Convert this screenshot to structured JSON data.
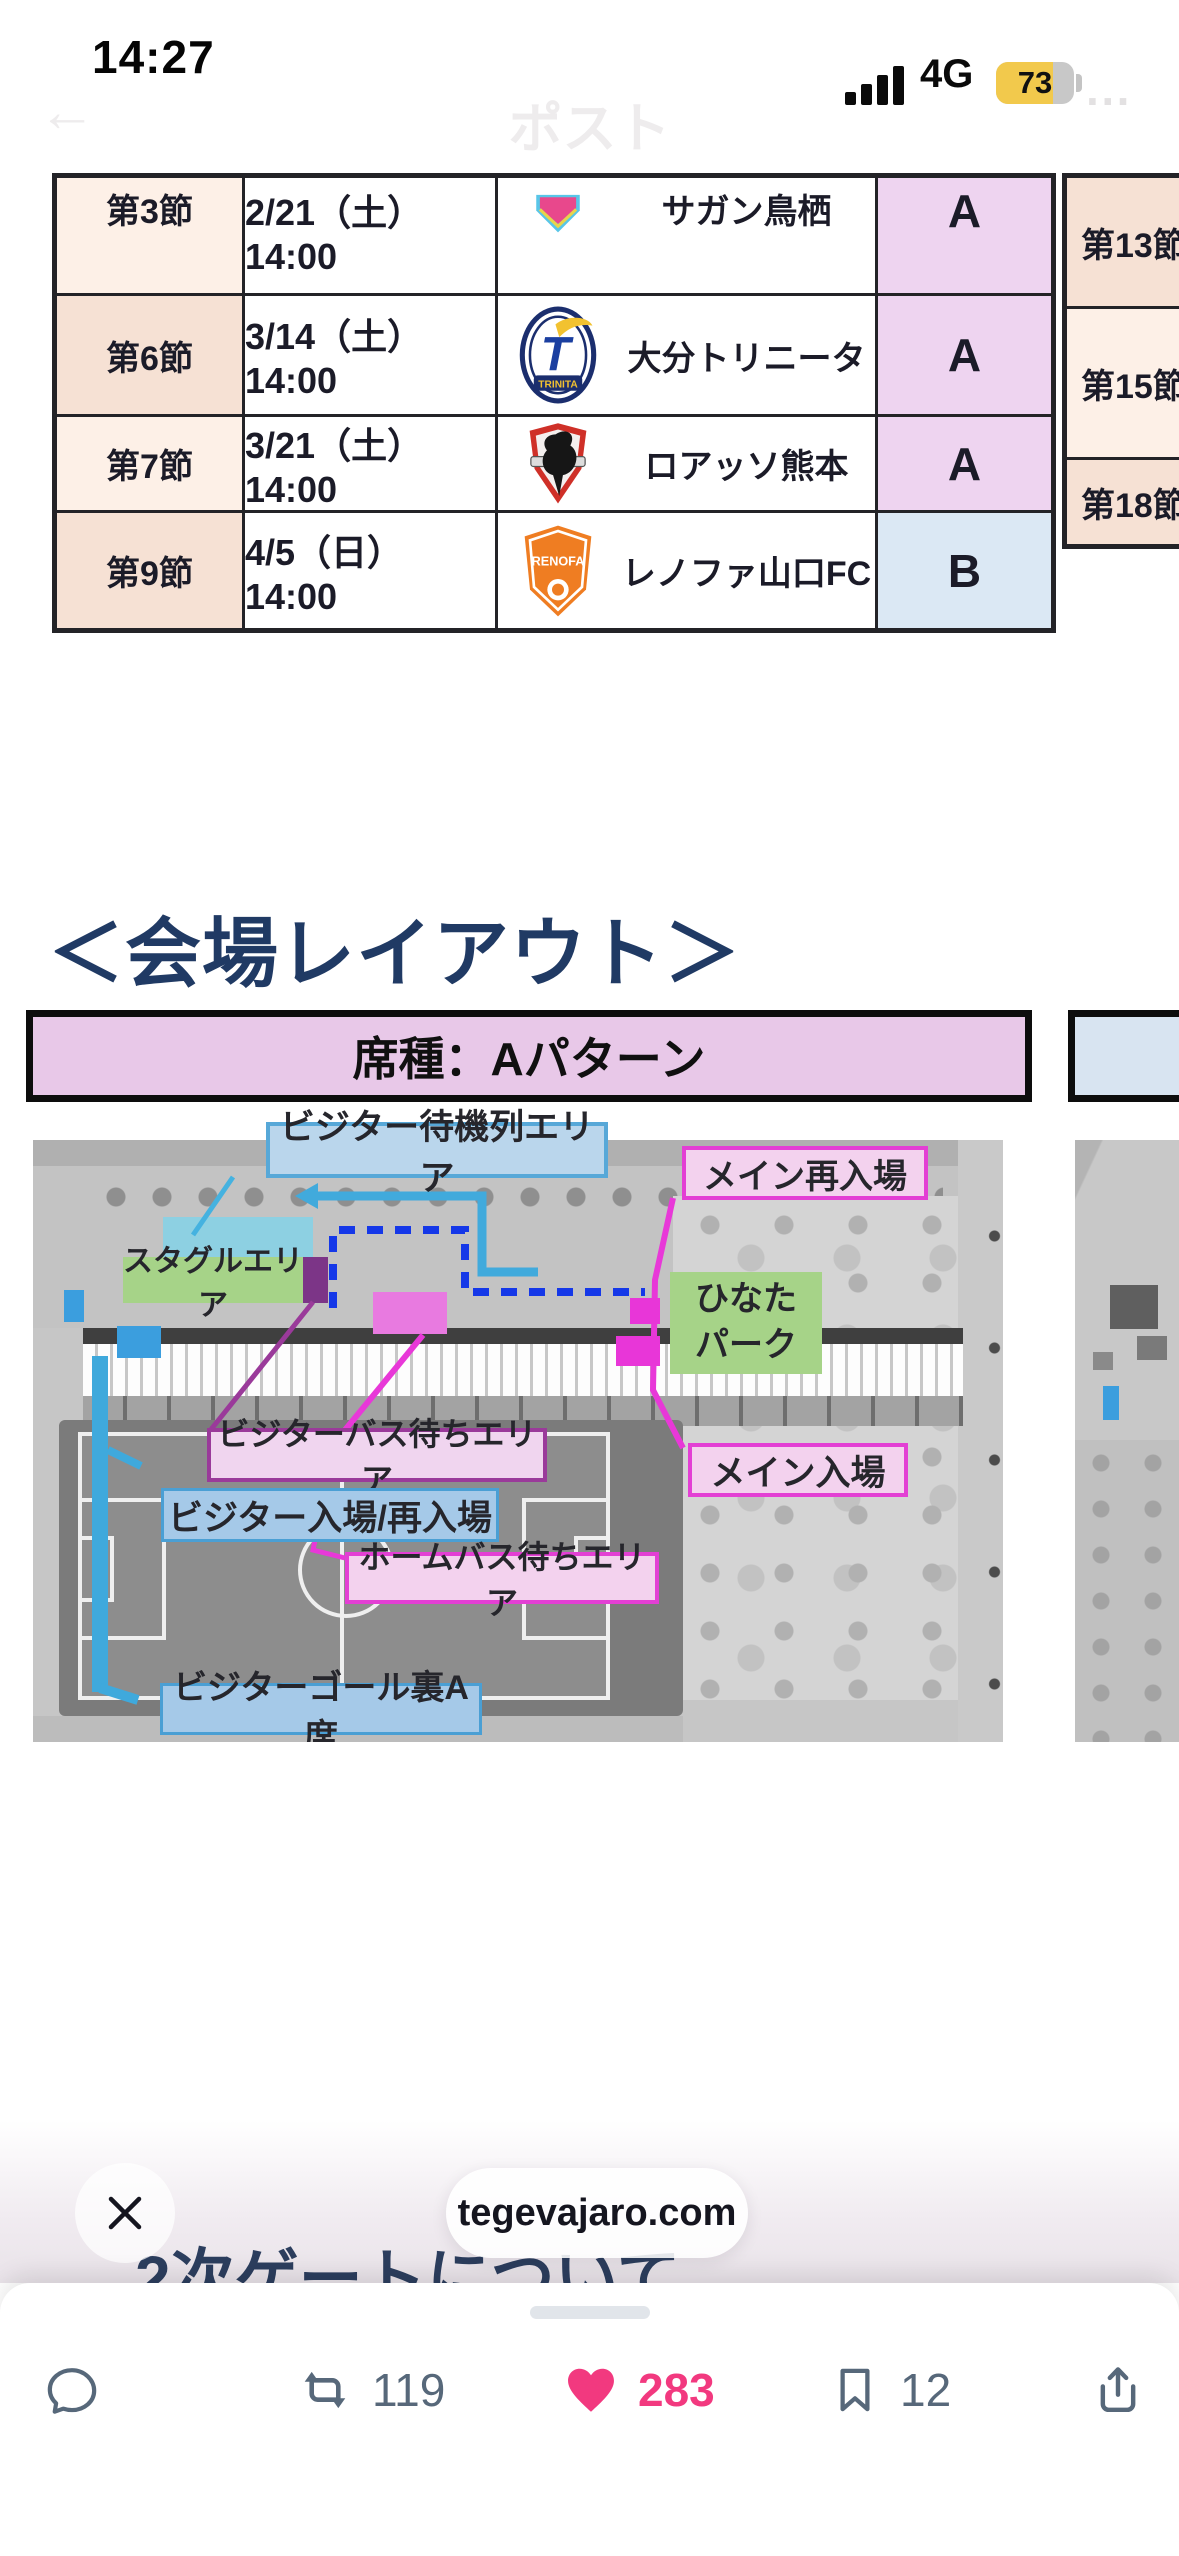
{
  "status_bar": {
    "time": "14:27",
    "network": "4G",
    "battery_percent": "73"
  },
  "nav_overlay": {
    "back_glyph": "←",
    "title": "ポスト",
    "more_glyph": "···"
  },
  "fixture_table": {
    "rows": [
      {
        "round": "第3節",
        "datetime": "2/21（土）14:00",
        "team": "サガン鳥栖",
        "pattern": "A",
        "logo": "sagan-tosu"
      },
      {
        "round": "第6節",
        "datetime": "3/14（土）14:00",
        "team": "大分トリニータ",
        "pattern": "A",
        "logo": "oita-trinita"
      },
      {
        "round": "第7節",
        "datetime": "3/21（土）14:00",
        "team": "ロアッソ熊本",
        "pattern": "A",
        "logo": "roasso-kumamoto"
      },
      {
        "round": "第9節",
        "datetime": "4/5（日）14:00",
        "team": "レノファ山口FC",
        "pattern": "B",
        "logo": "renofa-yamaguchi"
      }
    ]
  },
  "side_table": {
    "rows": [
      {
        "round": "第13節"
      },
      {
        "round": "第15節"
      },
      {
        "round": "第18節"
      }
    ]
  },
  "section": {
    "heading": "＜会場レイアウト＞",
    "banner_a": "席種：Aパターン"
  },
  "map_labels": {
    "visitor_queue": "ビジター待機列エリア",
    "stadium_gourmet": "スタグルエリア",
    "main_reentry": "メイン再入場",
    "hinata_park": "ひなた\nパーク",
    "visitor_bus_wait": "ビジターバス待ちエリア",
    "visitor_entry": "ビジター入場/再入場",
    "main_entry": "メイン入場",
    "home_bus_wait": "ホームバス待ちエリア",
    "visitor_goal_seat": "ビジターゴール裏A席"
  },
  "logos": {
    "trinita_text": "TRINITA",
    "renofa_text": "RENOFA"
  },
  "link_pill": {
    "domain": "tegevajaro.com"
  },
  "hidden_heading": "2次ゲートについて",
  "action_bar": {
    "retweet_count": "119",
    "like_count": "283",
    "bookmark_count": "12"
  },
  "icons": {
    "back": "arrow-left",
    "more": "ellipsis",
    "close": "x-mark",
    "reply": "speech-bubble",
    "repost": "retweet-arrows",
    "like": "heart-filled",
    "bookmark": "bookmark-outline",
    "share": "ios-share-up-arrow"
  },
  "colors": {
    "like_pink": "#f2397f",
    "battery_yellow": "#f2c94c",
    "banner_pink": "#e8c8e8",
    "banner_blue": "#d8e4f1",
    "pattern_a_fill": "#eed4f0",
    "pattern_b_fill": "#dbe8f4",
    "peach_dark": "#f6e1d4",
    "peach_light": "#fdf0e7",
    "heading_navy": "#203a64",
    "route_cyan": "#3fa9dc",
    "route_blue_dashed": "#1538e8",
    "route_magenta": "#e838d8",
    "label_green": "#a6d388"
  }
}
